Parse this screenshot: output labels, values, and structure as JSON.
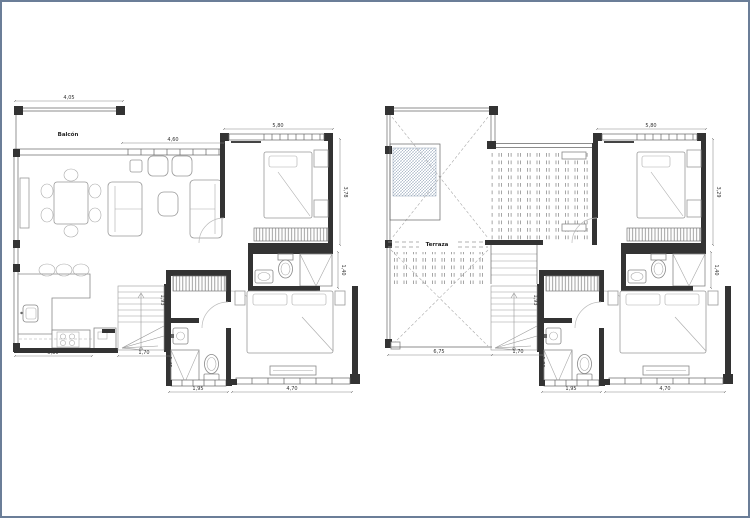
{
  "sheet": {
    "background": "#ffffff",
    "frame_color": "#6b7e98"
  },
  "plans": {
    "left": {
      "labels": {
        "balcony": "Balcón"
      },
      "dims": {
        "balcony_width": "4,05",
        "living_window": "4,60",
        "bedroom1_width": "5,80",
        "bedroom1_height": "3,78",
        "ensuite_shower": "1,40",
        "kitchen_width": "5,80",
        "stairs_width": "1,70",
        "bath_window": "1,95",
        "bedroom2_window": "4,70",
        "hall_upper": "1,93",
        "hall_lower": "1,45"
      }
    },
    "right": {
      "labels": {
        "terrace": "Terraza"
      },
      "dims": {
        "bedroom1_width": "5,80",
        "bedroom1_height": "3,29",
        "ensuite_shower": "1,40",
        "terrace_width": "6,75",
        "stairs_width": "1,70",
        "bath_window": "1,95",
        "bedroom2_window": "4,70",
        "hall_upper": "1,93",
        "hall_lower": "1,80"
      }
    }
  }
}
